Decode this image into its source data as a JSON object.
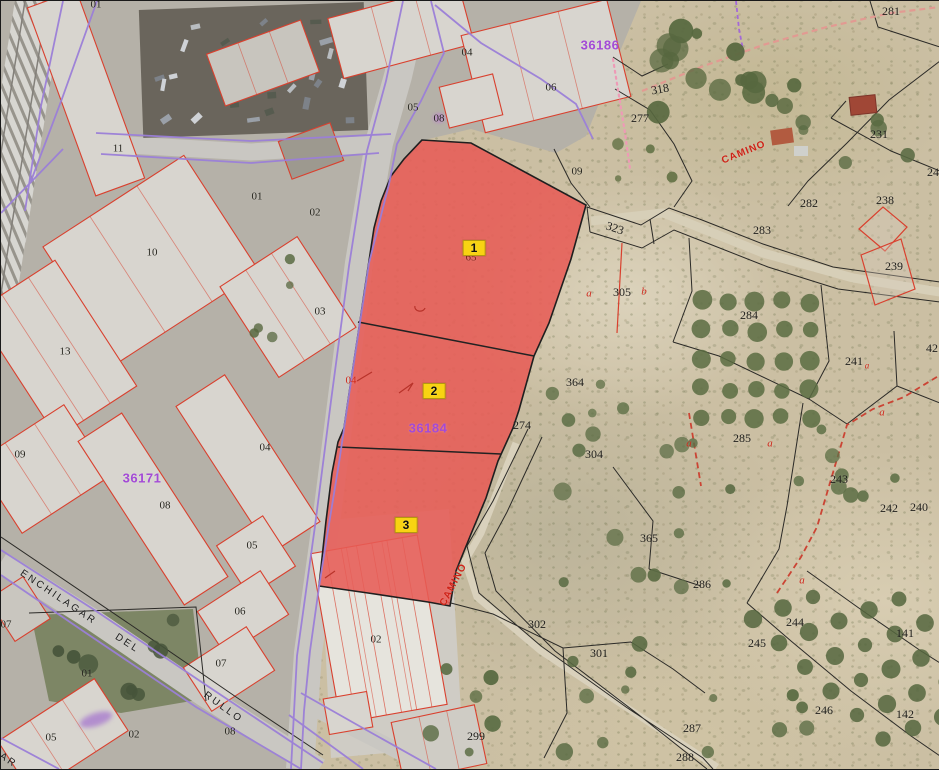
{
  "map": {
    "type": "cadastral-aerial-viewer",
    "selection": {
      "zone_fill": "#e75c56",
      "badge_bg": "#f8d312",
      "parcels": [
        {
          "t": "1",
          "x": 473,
          "y": 247
        },
        {
          "t": "2",
          "x": 433,
          "y": 390
        },
        {
          "t": "3",
          "x": 405,
          "y": 524
        }
      ]
    },
    "labels": {
      "zone_ids": [
        {
          "t": "36186",
          "x": 599,
          "y": 44
        },
        {
          "t": "36184",
          "x": 427,
          "y": 427
        },
        {
          "t": "36171",
          "x": 141,
          "y": 477
        }
      ],
      "rural": [
        {
          "t": "323",
          "x": 614,
          "y": 227,
          "r": 18
        },
        {
          "t": "305",
          "x": 621,
          "y": 291
        },
        {
          "t": "364",
          "x": 574,
          "y": 381
        },
        {
          "t": "274",
          "x": 521,
          "y": 424
        },
        {
          "t": "304",
          "x": 593,
          "y": 453
        },
        {
          "t": "302",
          "x": 536,
          "y": 623
        },
        {
          "t": "301",
          "x": 598,
          "y": 652
        },
        {
          "t": "299",
          "x": 475,
          "y": 735
        },
        {
          "t": "318",
          "x": 659,
          "y": 88,
          "r": -10
        },
        {
          "t": "277",
          "x": 639,
          "y": 117
        },
        {
          "t": "281",
          "x": 890,
          "y": 10
        },
        {
          "t": "231",
          "x": 878,
          "y": 133
        },
        {
          "t": "282",
          "x": 808,
          "y": 202
        },
        {
          "t": "283",
          "x": 761,
          "y": 229
        },
        {
          "t": "238",
          "x": 884,
          "y": 199
        },
        {
          "t": "239",
          "x": 893,
          "y": 265
        },
        {
          "t": "284",
          "x": 748,
          "y": 314
        },
        {
          "t": "241",
          "x": 853,
          "y": 360
        },
        {
          "t": "240",
          "x": 918,
          "y": 506
        },
        {
          "t": "242",
          "x": 888,
          "y": 507
        },
        {
          "t": "243",
          "x": 838,
          "y": 478
        },
        {
          "t": "285",
          "x": 741,
          "y": 437
        },
        {
          "t": "365",
          "x": 648,
          "y": 537
        },
        {
          "t": "286",
          "x": 701,
          "y": 583
        },
        {
          "t": "244",
          "x": 794,
          "y": 621
        },
        {
          "t": "245",
          "x": 756,
          "y": 642
        },
        {
          "t": "141",
          "x": 904,
          "y": 632
        },
        {
          "t": "142",
          "x": 904,
          "y": 713
        },
        {
          "t": "246",
          "x": 823,
          "y": 709
        },
        {
          "t": "287",
          "x": 691,
          "y": 727
        },
        {
          "t": "288",
          "x": 684,
          "y": 756
        },
        {
          "t": "24",
          "x": 932,
          "y": 171
        },
        {
          "t": "42",
          "x": 931,
          "y": 347
        }
      ],
      "urban": [
        {
          "t": "01",
          "x": 95,
          "y": 4
        },
        {
          "t": "11",
          "x": 117,
          "y": 148
        },
        {
          "t": "01",
          "x": 256,
          "y": 196
        },
        {
          "t": "02",
          "x": 314,
          "y": 212
        },
        {
          "t": "10",
          "x": 151,
          "y": 252
        },
        {
          "t": "03",
          "x": 319,
          "y": 311
        },
        {
          "t": "13",
          "x": 64,
          "y": 351
        },
        {
          "t": "09",
          "x": 19,
          "y": 454
        },
        {
          "t": "04",
          "x": 264,
          "y": 447
        },
        {
          "t": "08",
          "x": 164,
          "y": 505
        },
        {
          "t": "05",
          "x": 251,
          "y": 545
        },
        {
          "t": "06",
          "x": 239,
          "y": 611
        },
        {
          "t": "07",
          "x": 220,
          "y": 663
        },
        {
          "t": "01",
          "x": 86,
          "y": 673
        },
        {
          "t": "05",
          "x": 50,
          "y": 737
        },
        {
          "t": "02",
          "x": 133,
          "y": 734
        },
        {
          "t": "08",
          "x": 229,
          "y": 731
        },
        {
          "t": "07",
          "x": 5,
          "y": 624
        },
        {
          "t": "04",
          "x": 466,
          "y": 52
        },
        {
          "t": "05",
          "x": 412,
          "y": 107
        },
        {
          "t": "08",
          "x": 438,
          "y": 118
        },
        {
          "t": "06",
          "x": 550,
          "y": 87
        },
        {
          "t": "09",
          "x": 576,
          "y": 171
        },
        {
          "t": "02",
          "x": 375,
          "y": 639
        }
      ],
      "red_letters": [
        {
          "t": "a",
          "x": 588,
          "y": 293
        },
        {
          "t": "b",
          "x": 643,
          "y": 291
        },
        {
          "t": "a",
          "x": 688,
          "y": 443
        },
        {
          "t": "a",
          "x": 769,
          "y": 443
        },
        {
          "t": "a",
          "x": 881,
          "y": 412
        },
        {
          "t": "a",
          "x": 801,
          "y": 580
        },
        {
          "t": "a",
          "x": 866,
          "y": 365,
          "fs": 9
        }
      ],
      "misc": [
        {
          "t": "65",
          "x": 470,
          "y": 257,
          "cls": "lbl-hidden65"
        },
        {
          "t": "04",
          "x": 350,
          "y": 380,
          "cls": "lbl-red04"
        }
      ],
      "streets": [
        {
          "t": "ENCHILAGAR",
          "x": 57,
          "y": 597,
          "r": 34
        },
        {
          "t": "DEL",
          "x": 126,
          "y": 643,
          "r": 33
        },
        {
          "t": "RULLO",
          "x": 222,
          "y": 707,
          "r": 36
        },
        {
          "t": "AR",
          "x": 7,
          "y": 760,
          "r": 34
        }
      ],
      "caminos": [
        {
          "t": "CAMINO",
          "x": 453,
          "y": 584,
          "r": -62
        },
        {
          "t": "CAMINO",
          "x": 743,
          "y": 152,
          "r": -22
        }
      ]
    },
    "legend_colors": {
      "urban_parcel_line": "#d9402e",
      "road_boundary_line": "#9b7fd8",
      "rural_boundary_line": "#2b2a27",
      "zone_id_text": "#a34ad6",
      "camino_dash": "#cb4434",
      "pink_boundary_dots": "#ee9ab6"
    }
  }
}
